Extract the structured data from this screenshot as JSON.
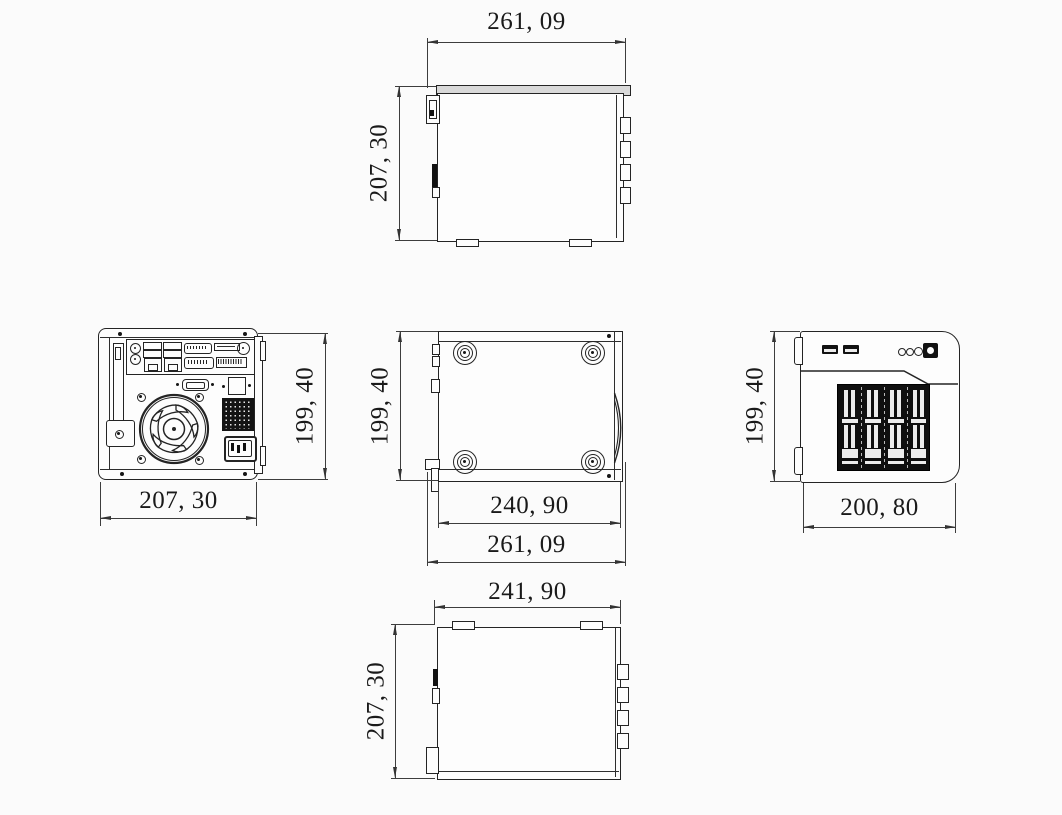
{
  "views": {
    "side_top": {
      "dims": {
        "width": "261, 09",
        "height": "207, 30"
      }
    },
    "rear": {
      "dims": {
        "width": "207, 30",
        "height": "199, 40"
      }
    },
    "bottom": {
      "dims": {
        "height": "199, 40",
        "inner_width": "240, 90",
        "outer_width": "261, 09"
      }
    },
    "front": {
      "dims": {
        "height": "199, 40",
        "width": "200, 80"
      }
    },
    "side_bottom": {
      "dims": {
        "width": "241, 90",
        "height": "207, 30"
      }
    }
  },
  "colors": {
    "line": "#242424",
    "dim_line": "#3d3d3d",
    "background": "#fbfbfb",
    "dark_fill": "#121212"
  }
}
